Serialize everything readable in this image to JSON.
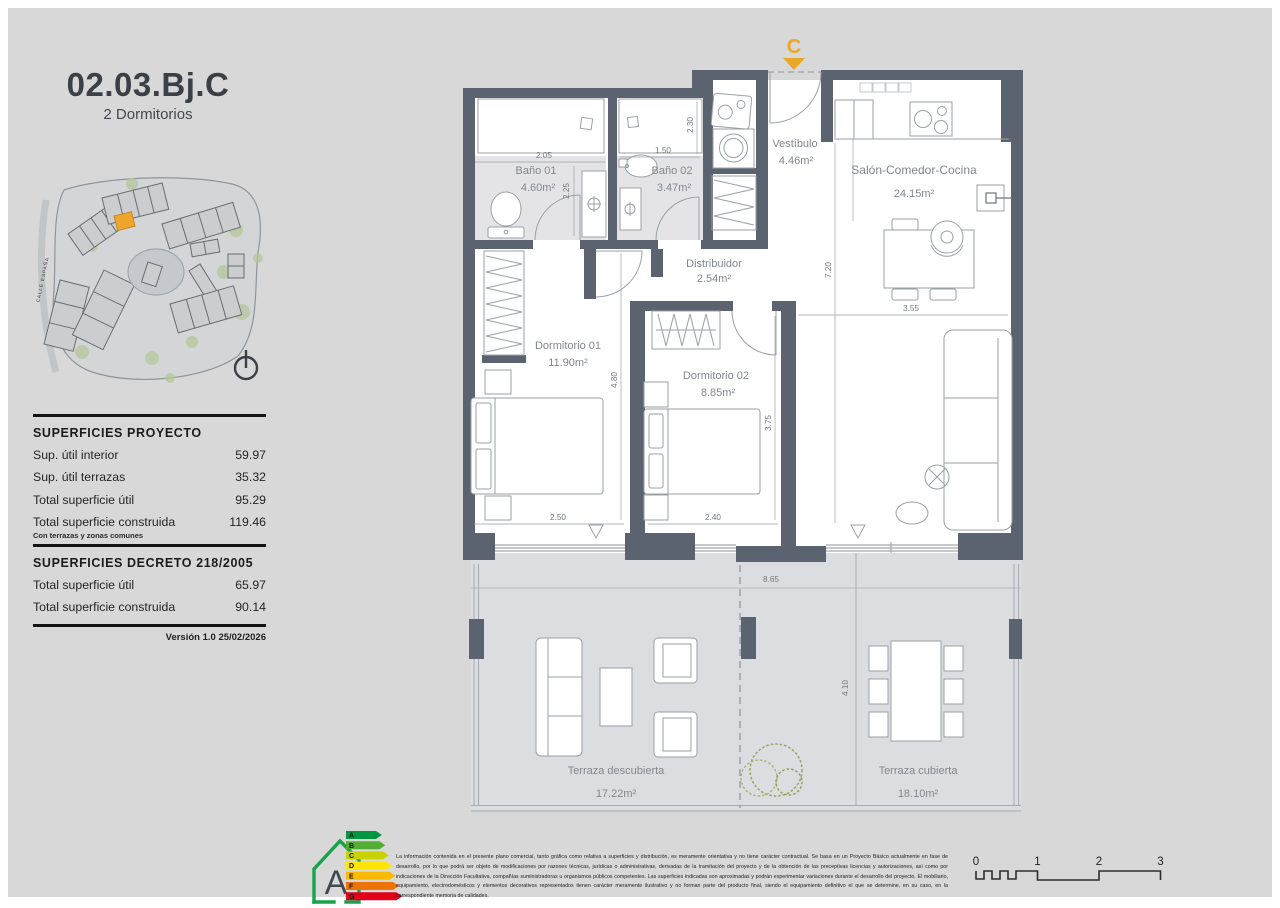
{
  "header": {
    "title": "02.03.Bj.C",
    "subtitle": "2 Dormitorios"
  },
  "site": {
    "street": "CALLE ESPAÑA"
  },
  "tables": {
    "project": {
      "title": "SUPERFICIES PROYECTO",
      "rows": [
        {
          "label": "Sup. útil interior",
          "value": "59.97"
        },
        {
          "label": "Sup. útil terrazas",
          "value": "35.32"
        },
        {
          "label": "Total superficie útil",
          "value": "95.29"
        },
        {
          "label": "Total superficie construida",
          "value": "119.46"
        }
      ],
      "note": "Con terrazas y zonas comunes"
    },
    "decree": {
      "title": "SUPERFICIES DECRETO 218/2005",
      "rows": [
        {
          "label": "Total superficie útil",
          "value": "65.97"
        },
        {
          "label": "Total superficie construida",
          "value": "90.14"
        }
      ]
    }
  },
  "meta": {
    "version": "Versión 1.0 25/02/2026"
  },
  "plan": {
    "marker": "C",
    "rooms": {
      "vestibulo": {
        "name": "Vestíbulo",
        "area": "4.46m²"
      },
      "bano1": {
        "name": "Baño 01",
        "area": "4.60m²"
      },
      "bano2": {
        "name": "Baño 02",
        "area": "3.47m²"
      },
      "distribuidor": {
        "name": "Distribuidor",
        "area": "2.54m²"
      },
      "salon": {
        "name": "Salón-Comedor-Cocina",
        "area": "24.15m²"
      },
      "dorm1": {
        "name": "Dormitorio 01",
        "area": "11.90m²"
      },
      "dorm2": {
        "name": "Dormitorio 02",
        "area": "8.85m²"
      },
      "terraza_descubierta": {
        "name": "Terraza descubierta",
        "area": "17.22m²"
      },
      "terraza_cubierta": {
        "name": "Terraza cubierta",
        "area": "18.10m²"
      }
    },
    "dims": {
      "bano1_w": "2.05",
      "bano1_h": "2.25",
      "bano2_w": "1.50",
      "bano2_h": "2.30",
      "dorm1_w": "2.50",
      "dorm1_h": "4.80",
      "dorm2_w": "2.40",
      "dorm2_h": "3.75",
      "salon_w": "3.55",
      "salon_h": "7.20",
      "terraza_w": "8.65",
      "terraza_h": "4.10"
    }
  },
  "energy": {
    "rating": "A",
    "scale": [
      "A",
      "B",
      "C",
      "D",
      "E",
      "F",
      "G"
    ],
    "colors": [
      "#009640",
      "#52ae32",
      "#c8d200",
      "#ffe500",
      "#fbba00",
      "#ec7404",
      "#e2001a"
    ],
    "house_color": "#18a24b"
  },
  "disclaimer": {
    "text": "La información contenida en el presente plano comercial, tanto gráfica como relativa a superficies y distribución, es meramente orientativa y no tiene carácter contractual. Se basa en un Proyecto Básico actualmente en fase de desarrollo, por lo que podrá ser objeto de modificaciones por razones técnicas, jurídicas o administrativas, derivadas de la tramitación del proyecto y de la obtención de las preceptivas licencias y autorizaciones, así como por indicaciones de la Dirección Facultativa, compañías suministradoras u organismos públicos competentes. Las superficies indicadas son aproximadas y podrán experimentar variaciones durante el desarrollo del proyecto. El mobiliario, equipamiento, electrodomésticos y elementos decorativos representados tienen carácter meramente ilustrativo y no forman parte del producto final, siendo el equipamiento definitivo el que se determine, en su caso, en la correspondiente memoria de calidades."
  },
  "scalebar": {
    "ticks": [
      "0",
      "1",
      "2",
      "3"
    ]
  },
  "colors": {
    "canvas": "#d8d8d8",
    "wall": "#5c6370",
    "accent": "#e9a825",
    "bath_floor": "#e4e4e6",
    "terrace_floor": "#dcdde0"
  }
}
